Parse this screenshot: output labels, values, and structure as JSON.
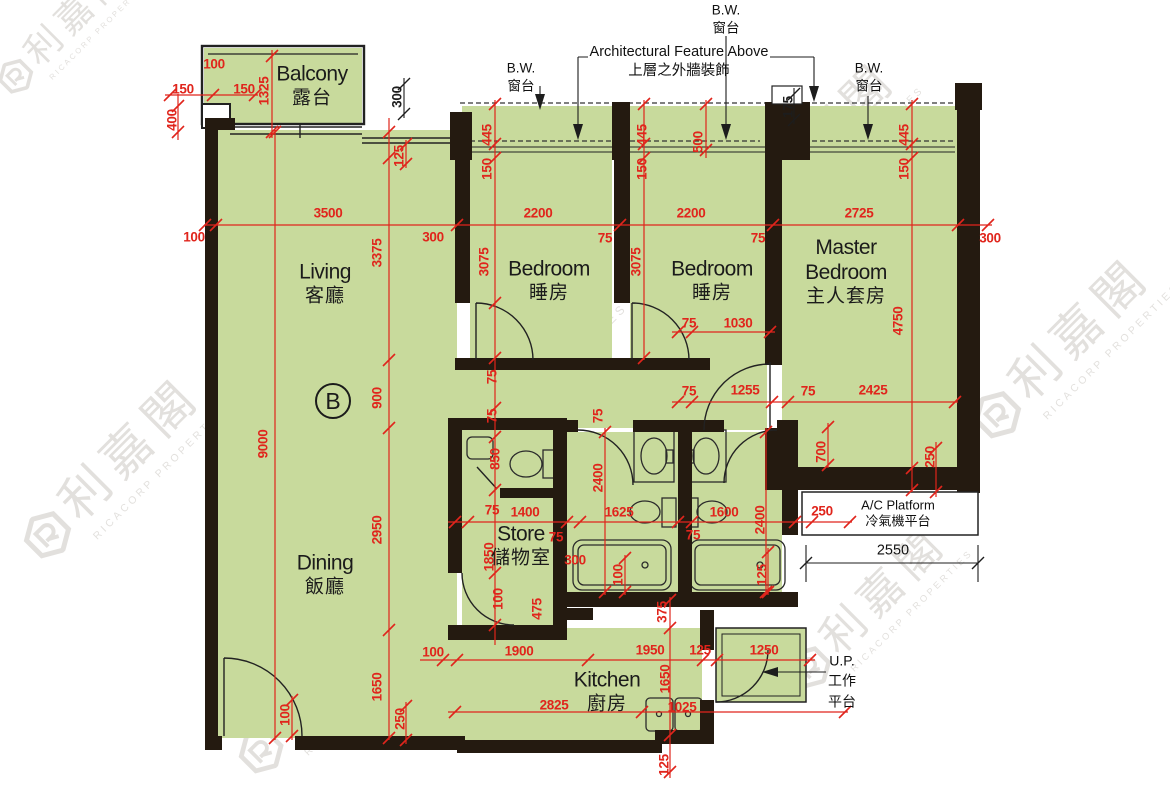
{
  "colors": {
    "floor": "#c8da9c",
    "wall": "#241a10",
    "dimension_red": "#e0251c",
    "line_black": "#1d1d1d"
  },
  "unit": {
    "label": "B"
  },
  "rooms": [
    {
      "id": "balcony",
      "en": "Balcony",
      "zh": "露台",
      "x": 312,
      "y": 86
    },
    {
      "id": "living",
      "en": "Living",
      "zh": "客廳",
      "x": 325,
      "y": 284
    },
    {
      "id": "dining",
      "en": "Dining",
      "zh": "飯廳",
      "x": 325,
      "y": 575
    },
    {
      "id": "bedroom-1",
      "en": "Bedroom",
      "zh": "睡房",
      "x": 549,
      "y": 281
    },
    {
      "id": "bedroom-2",
      "en": "Bedroom",
      "zh": "睡房",
      "x": 712,
      "y": 281
    },
    {
      "id": "master-bedroom",
      "en": "Master Bedroom",
      "zh": "主人套房",
      "x": 846,
      "y": 272,
      "w": 118
    },
    {
      "id": "store",
      "en": "Store",
      "zh": "儲物室",
      "x": 521,
      "y": 546
    },
    {
      "id": "kitchen",
      "en": "Kitchen",
      "zh": "廚房",
      "x": 607,
      "y": 692
    }
  ],
  "callouts": [
    {
      "id": "bw-left",
      "cls": "",
      "lines": [
        "B.W.",
        "窗台"
      ],
      "x": 521,
      "y": 77
    },
    {
      "id": "bw-middle",
      "cls": "",
      "lines": [
        "B.W.",
        "窗台"
      ],
      "x": 726,
      "y": 19
    },
    {
      "id": "bw-right",
      "cls": "",
      "lines": [
        "B.W.",
        "窗台"
      ],
      "x": 869,
      "y": 77
    },
    {
      "id": "architectural-feature",
      "cls": "arch",
      "lines": [
        "Architectural Feature Above",
        "上層之外牆裝飾"
      ],
      "x": 679,
      "y": 62
    },
    {
      "id": "ac-platform",
      "cls": "ac",
      "lines": [
        "A/C Platform",
        "冷氣機平台"
      ],
      "x": 898,
      "y": 513
    },
    {
      "id": "utility-platform",
      "cls": "up",
      "lines": [
        "U.P.",
        "工作",
        "平台"
      ],
      "x": 842,
      "y": 681
    },
    {
      "id": "ac-platform-width",
      "cls": "blackdim",
      "lines": [
        "2550"
      ],
      "x": 893,
      "y": 551
    }
  ],
  "dim_labels": [
    {
      "t": "100",
      "x": 214,
      "y": 64
    },
    {
      "t": "150",
      "x": 183,
      "y": 89
    },
    {
      "t": "150",
      "x": 244,
      "y": 89
    },
    {
      "t": "400",
      "x": 172,
      "y": 120,
      "v": 1
    },
    {
      "t": "1325",
      "x": 264,
      "y": 91,
      "v": 1
    },
    {
      "t": "300",
      "x": 397,
      "y": 97,
      "v": 1,
      "k": 1
    },
    {
      "t": "125",
      "x": 399,
      "y": 156,
      "v": 1
    },
    {
      "t": "445",
      "x": 487,
      "y": 135,
      "v": 1
    },
    {
      "t": "150",
      "x": 487,
      "y": 169,
      "v": 1
    },
    {
      "t": "445",
      "x": 642,
      "y": 135,
      "v": 1
    },
    {
      "t": "150",
      "x": 642,
      "y": 169,
      "v": 1
    },
    {
      "t": "500",
      "x": 698,
      "y": 142,
      "v": 1
    },
    {
      "t": "175",
      "x": 788,
      "y": 107,
      "v": 1,
      "k": 1
    },
    {
      "t": "445",
      "x": 904,
      "y": 135,
      "v": 1
    },
    {
      "t": "150",
      "x": 904,
      "y": 169,
      "v": 1
    },
    {
      "t": "3500",
      "x": 328,
      "y": 213
    },
    {
      "t": "2200",
      "x": 538,
      "y": 213
    },
    {
      "t": "2200",
      "x": 691,
      "y": 213
    },
    {
      "t": "2725",
      "x": 859,
      "y": 213
    },
    {
      "t": "100",
      "x": 194,
      "y": 237
    },
    {
      "t": "300",
      "x": 433,
      "y": 237
    },
    {
      "t": "75",
      "x": 605,
      "y": 238
    },
    {
      "t": "75",
      "x": 758,
      "y": 238
    },
    {
      "t": "300",
      "x": 990,
      "y": 238
    },
    {
      "t": "9000",
      "x": 263,
      "y": 444,
      "v": 1
    },
    {
      "t": "3375",
      "x": 377,
      "y": 253,
      "v": 1
    },
    {
      "t": "900",
      "x": 377,
      "y": 398,
      "v": 1
    },
    {
      "t": "2950",
      "x": 377,
      "y": 530,
      "v": 1
    },
    {
      "t": "1650",
      "x": 377,
      "y": 687,
      "v": 1
    },
    {
      "t": "3075",
      "x": 484,
      "y": 262,
      "v": 1
    },
    {
      "t": "3075",
      "x": 636,
      "y": 262,
      "v": 1
    },
    {
      "t": "4750",
      "x": 898,
      "y": 321,
      "v": 1
    },
    {
      "t": "75",
      "x": 689,
      "y": 323
    },
    {
      "t": "1030",
      "x": 738,
      "y": 323
    },
    {
      "t": "75",
      "x": 689,
      "y": 391
    },
    {
      "t": "1255",
      "x": 745,
      "y": 390
    },
    {
      "t": "75",
      "x": 808,
      "y": 391
    },
    {
      "t": "2425",
      "x": 873,
      "y": 390
    },
    {
      "t": "75",
      "x": 492,
      "y": 377,
      "v": 1
    },
    {
      "t": "75",
      "x": 492,
      "y": 416,
      "v": 1
    },
    {
      "t": "75",
      "x": 598,
      "y": 416,
      "v": 1
    },
    {
      "t": "850",
      "x": 495,
      "y": 459,
      "v": 1
    },
    {
      "t": "2400",
      "x": 598,
      "y": 478,
      "v": 1
    },
    {
      "t": "700",
      "x": 821,
      "y": 452,
      "v": 1
    },
    {
      "t": "250",
      "x": 930,
      "y": 457,
      "v": 1
    },
    {
      "t": "75",
      "x": 492,
      "y": 510
    },
    {
      "t": "1400",
      "x": 525,
      "y": 512
    },
    {
      "t": "1625",
      "x": 619,
      "y": 512
    },
    {
      "t": "1600",
      "x": 724,
      "y": 512
    },
    {
      "t": "2400",
      "x": 760,
      "y": 520,
      "v": 1
    },
    {
      "t": "250",
      "x": 822,
      "y": 511
    },
    {
      "t": "75",
      "x": 556,
      "y": 537
    },
    {
      "t": "300",
      "x": 575,
      "y": 560
    },
    {
      "t": "75",
      "x": 693,
      "y": 535
    },
    {
      "t": "100",
      "x": 618,
      "y": 575,
      "v": 1
    },
    {
      "t": "125",
      "x": 762,
      "y": 575,
      "v": 1
    },
    {
      "t": "1850",
      "x": 489,
      "y": 557,
      "v": 1
    },
    {
      "t": "100",
      "x": 498,
      "y": 599,
      "v": 1
    },
    {
      "t": "475",
      "x": 537,
      "y": 609,
      "v": 1
    },
    {
      "t": "375",
      "x": 662,
      "y": 612,
      "v": 1
    },
    {
      "t": "100",
      "x": 433,
      "y": 652
    },
    {
      "t": "1900",
      "x": 519,
      "y": 651
    },
    {
      "t": "1950",
      "x": 650,
      "y": 650
    },
    {
      "t": "125",
      "x": 700,
      "y": 650
    },
    {
      "t": "1250",
      "x": 764,
      "y": 650
    },
    {
      "t": "1650",
      "x": 665,
      "y": 679,
      "v": 1
    },
    {
      "t": "2825",
      "x": 554,
      "y": 705
    },
    {
      "t": "1025",
      "x": 682,
      "y": 707
    },
    {
      "t": "125",
      "x": 664,
      "y": 765,
      "v": 1
    },
    {
      "t": "100",
      "x": 285,
      "y": 715,
      "v": 1
    },
    {
      "t": "250",
      "x": 400,
      "y": 719,
      "v": 1
    }
  ],
  "watermark": {
    "zh": "利嘉閣",
    "en": "RICACORP PROPERTIES",
    "positions": [
      {
        "x": -60,
        "y": -20,
        "s": 0.7
      },
      {
        "x": -10,
        "y": 420,
        "s": 0.95
      },
      {
        "x": 370,
        "y": 330,
        "s": 1.1
      },
      {
        "x": 690,
        "y": 100,
        "s": 0.9
      },
      {
        "x": 940,
        "y": 300,
        "s": 0.95
      },
      {
        "x": 745,
        "y": 560,
        "s": 0.85
      },
      {
        "x": 200,
        "y": 640,
        "s": 0.9
      }
    ]
  }
}
